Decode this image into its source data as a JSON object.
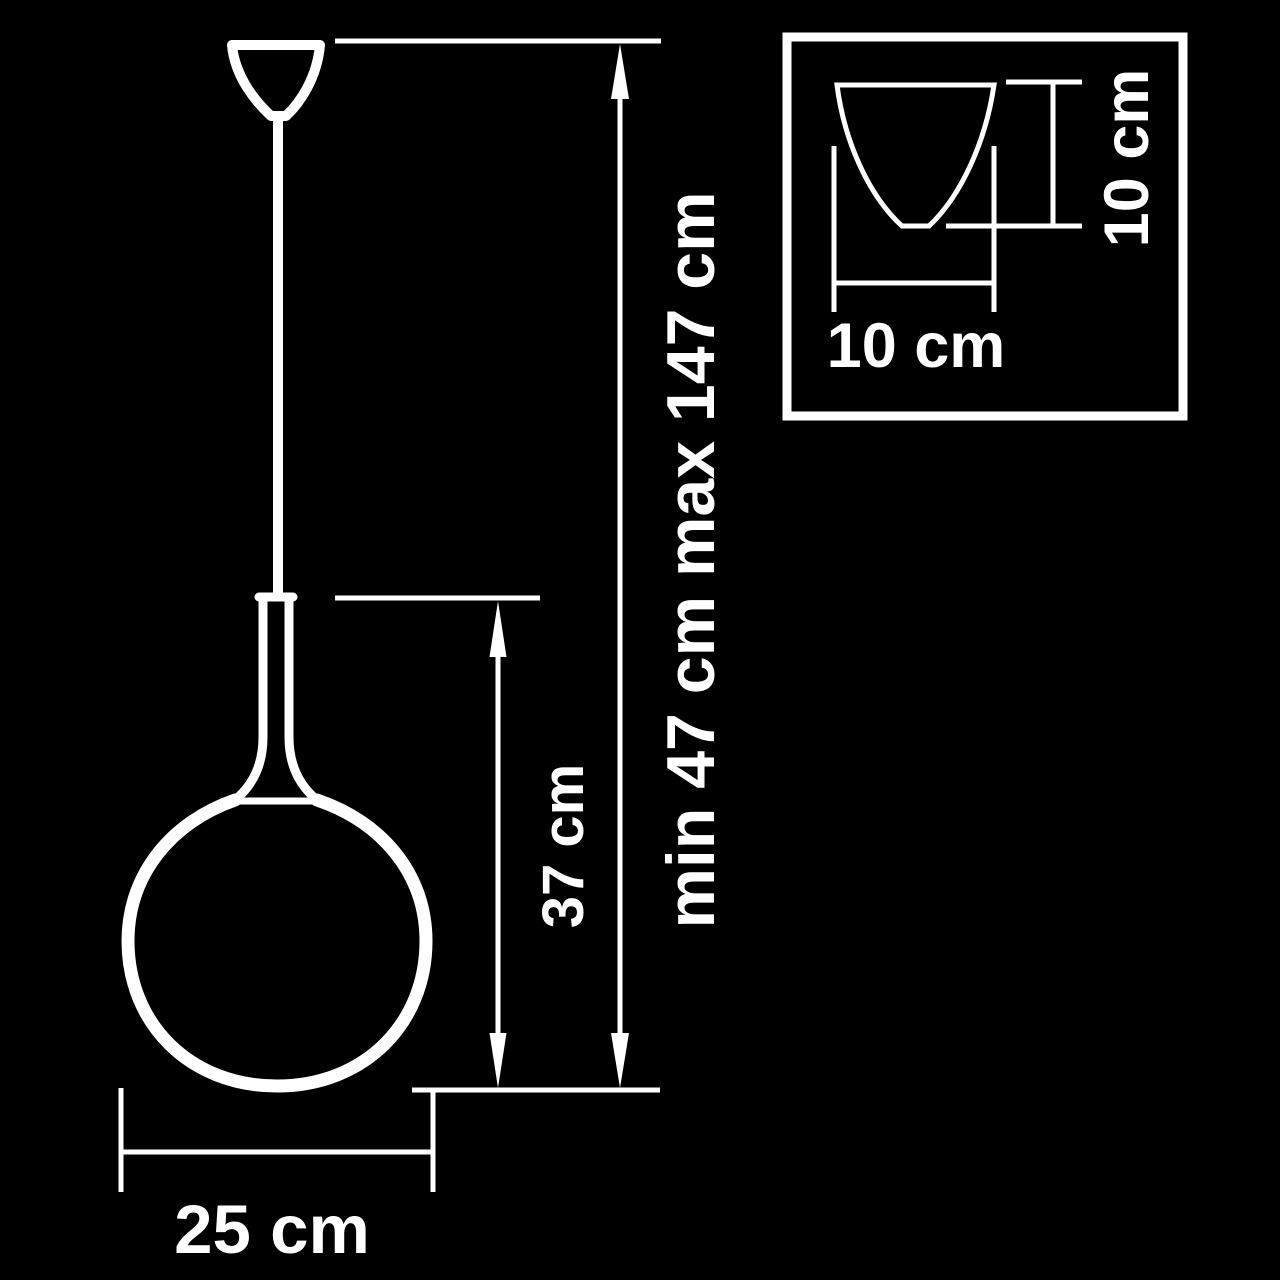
{
  "diagram": {
    "title": "pendant-lamp-dimension-drawing",
    "background_color": "#000000",
    "line_color": "#ffffff",
    "labels": {
      "shade_width": "25 cm",
      "shade_height": "37 cm",
      "overall_height": "min 47 cm max 147 cm"
    },
    "inset": {
      "canopy_width": "10 cm",
      "canopy_height": "10 cm"
    }
  }
}
